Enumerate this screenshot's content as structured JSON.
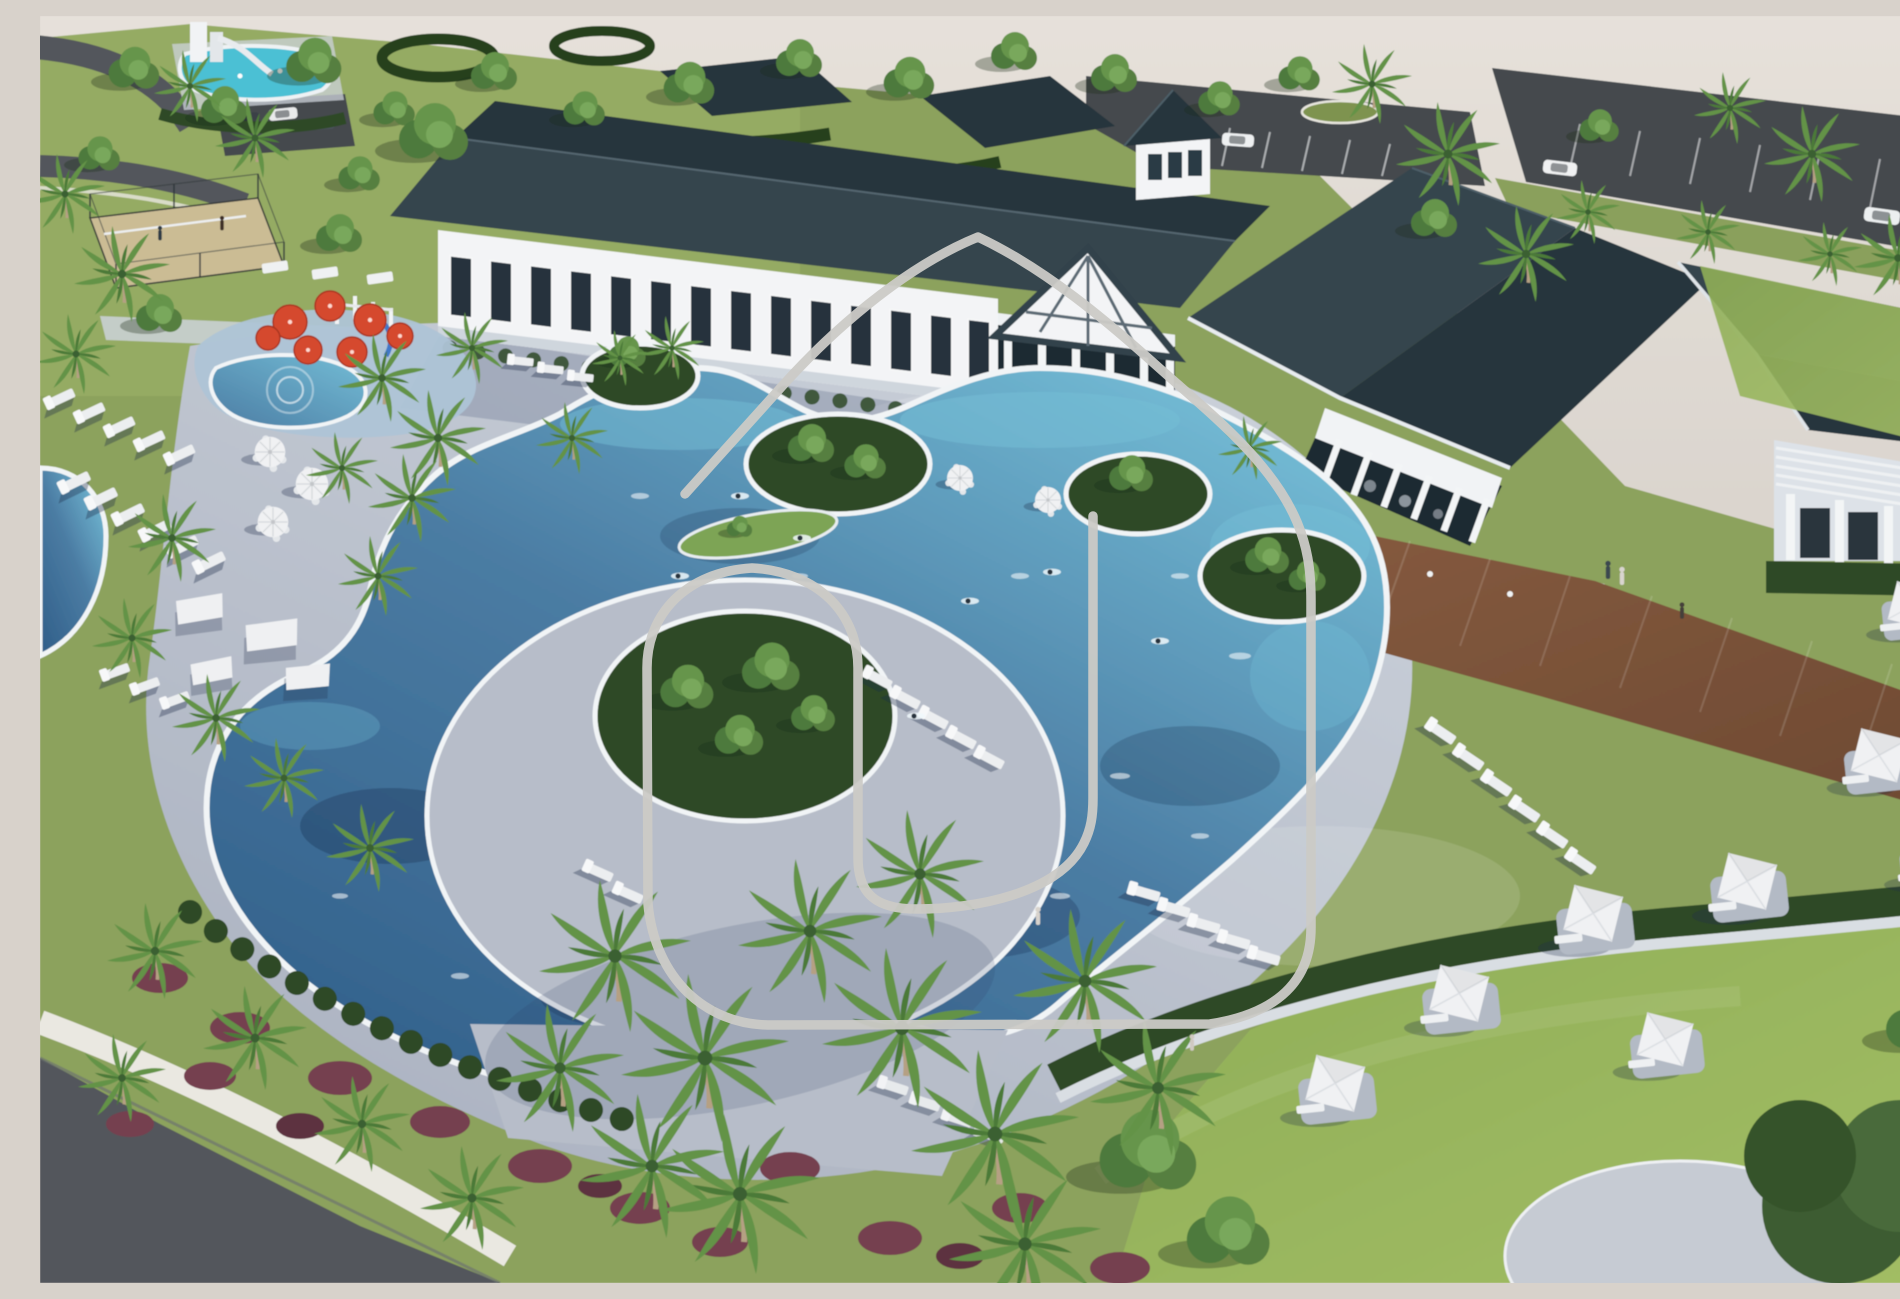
{
  "image": {
    "type": "architectural-rendering",
    "view": "aerial-oblique",
    "subject": "Resort-style community amenity center with lagoon pool and clubhouse"
  },
  "scene": {
    "description": "Aerial 3D rendering of a community amenity campus: a long white clubhouse with dark slate hip roofs, gabled porch and cupola; a large free-form lagoon pool with landscaped tree islands and swimmers; concrete pool deck with rows of white lounge chairs and market umbrella tables; a kids splash pad with red umbrellas; sand volleyball court and a second pool with slide in the distance; wooden boardwalk promenade on the right; curved hedge wall with white cabana umbrellas on the lawn at lower right; dense palms and maroon shrubs along a road at lower left; parking lots with cars at the top; a light gray looping logo outline is watermarked over the center.",
    "features": [
      "clubhouse with slate hip roofs and cupola",
      "free-form lagoon swimming pool",
      "planted tree islands in pool",
      "splash pad with red umbrellas",
      "sand volleyball court",
      "distant pool with water slide",
      "rows of white chaise loungers",
      "white market umbrellas with tables",
      "cabana umbrellas on lawn",
      "wooden boardwalk",
      "palm trees and maroon shrubs",
      "parking lots with cars",
      "gray logo outline watermark"
    ],
    "watermark": {
      "shape": "looping arch outline",
      "style": "rounded open stroke"
    },
    "people": {
      "swimmers": 7,
      "walkers": 4,
      "volleyball_players": 2
    }
  },
  "palette": {
    "sky": "#dad4cd",
    "sky-light": "#e6e1da",
    "grass": "#8ca25d",
    "grass-light": "#9db36a",
    "lawn": "#a2bd64",
    "hedge": "#2e4a28",
    "tree": "#598440",
    "tree-light": "#6f9d52",
    "palm": "#699a4b",
    "water-deep": "#2f5d88",
    "water-mid": "#4b7ca3",
    "water-light": "#74bdd6",
    "pool-distant": "#4cc0d4",
    "wet-deck": "#aec4d6",
    "coping": "#f1f4f6",
    "deck": "#b7bdc9",
    "deck-light": "#cdd3db",
    "roof": "#36454e",
    "roof-dark": "#27343c",
    "wall": "#f3f4f6",
    "wall-shade": "#dde2e8",
    "wood": "#8a5d41",
    "wood-dark": "#6e4a33",
    "asphalt": "#45494d",
    "road": "#53575b",
    "sidewalk": "#eae8e1",
    "sand": "#cbbc94",
    "umbrella-red": "#d54a2e",
    "umbrella-white": "#f0f1f3",
    "lounger": "#eceef0",
    "shrub-maroon": "#75414f",
    "watermark": "#cbcac6"
  }
}
